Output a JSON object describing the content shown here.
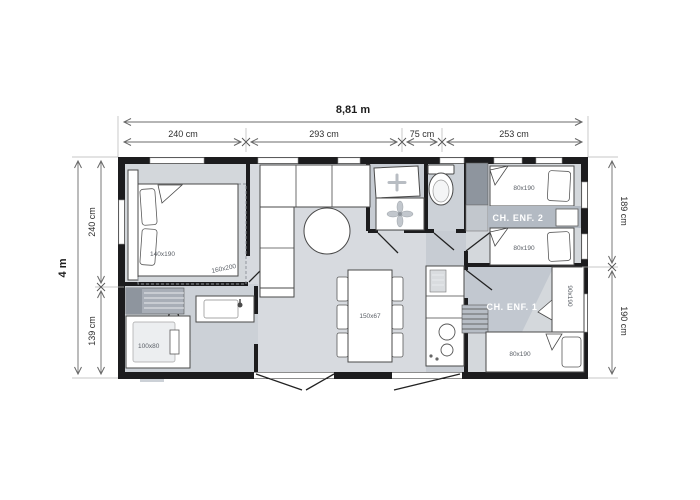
{
  "floor_plan": {
    "dimensions": {
      "total_width": "8,81 m",
      "total_height": "4 m",
      "top": [
        "240 cm",
        "293 cm",
        "75 cm",
        "253 cm"
      ],
      "left": [
        "240 cm",
        "139 cm"
      ],
      "right": [
        "189 cm",
        "190 cm"
      ]
    },
    "master_bedroom": {
      "bed": "140x190",
      "bed_option": "160x200"
    },
    "bathroom": {
      "shower": "100x80"
    },
    "dining": {
      "table": "150x67"
    },
    "kids_room_2": {
      "name": "CH. ENF. 2",
      "bed_top": "80x190",
      "bed_bottom": "80x190"
    },
    "kids_room_1": {
      "name": "CH. ENF. 1",
      "bed_side": "90x190",
      "bed_bottom": "80x190"
    }
  },
  "colors": {
    "wall": "#1c1c1e",
    "floor": "#d7dadf",
    "floor_dark": "#c7ccd3",
    "band": "#b3bac3",
    "wardrobe_dark": "#8e959e"
  }
}
